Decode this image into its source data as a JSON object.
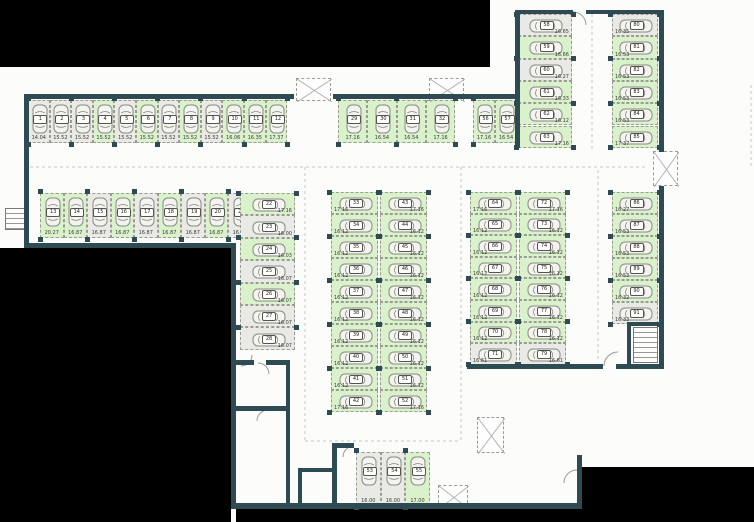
{
  "title": "underground-parking-floor-plan",
  "colors": {
    "wall": "#2e4a52",
    "space_available": "#d9f2cc",
    "space_unavailable": "#e9e9e5",
    "outside": "#000000",
    "background": "#fcfcfa",
    "cell_border": "#9b9b93",
    "text": "#3a3a36"
  },
  "floor_plan": {
    "groups": [
      {
        "id": "top-row",
        "type": "vrow",
        "x": 28,
        "y": 100,
        "cw": 21.6,
        "ch": 43,
        "spaces": [
          {
            "number": "1",
            "size": "14.04",
            "state": "unavailable"
          },
          {
            "number": "2",
            "size": "15.52",
            "state": "unavailable"
          },
          {
            "number": "3",
            "size": "15.52",
            "state": "unavailable"
          },
          {
            "number": "4",
            "size": "15.52",
            "state": "available"
          },
          {
            "number": "5",
            "size": "15.52",
            "state": "unavailable"
          },
          {
            "number": "6",
            "size": "15.52",
            "state": "available"
          },
          {
            "number": "7",
            "size": "15.52",
            "state": "unavailable"
          },
          {
            "number": "8",
            "size": "15.52",
            "state": "available"
          },
          {
            "number": "9",
            "size": "15.52",
            "state": "unavailable"
          },
          {
            "number": "10",
            "size": "16.06",
            "state": "available"
          },
          {
            "number": "11",
            "size": "16.35",
            "state": "available"
          },
          {
            "number": "12",
            "size": "17.37",
            "state": "available"
          }
        ]
      },
      {
        "id": "top-mid-row",
        "type": "vrow",
        "x": 338,
        "y": 100,
        "cw": 29.3,
        "ch": 43,
        "spaces": [
          {
            "number": "29",
            "size": "17.16",
            "state": "available"
          },
          {
            "number": "30",
            "size": "16.54",
            "state": "available"
          },
          {
            "number": "31",
            "size": "16.54",
            "state": "available"
          },
          {
            "number": "32",
            "size": "17.16",
            "state": "available"
          }
        ]
      },
      {
        "id": "top-right-pair",
        "type": "vrow",
        "x": 473,
        "y": 100,
        "cw": 22,
        "ch": 43,
        "spaces": [
          {
            "number": "56",
            "size": "17.16",
            "state": "available"
          },
          {
            "number": "57",
            "size": "16.54",
            "state": "available"
          }
        ]
      },
      {
        "id": "col-58-63",
        "type": "hcol",
        "x": 518,
        "y": 14,
        "cw": 54,
        "ch": 22.3,
        "side": "right",
        "spaces": [
          {
            "number": "58",
            "size": "16.65",
            "state": "unavailable"
          },
          {
            "number": "59",
            "size": "16.66",
            "state": "available"
          },
          {
            "number": "60",
            "size": "16.27",
            "state": "unavailable"
          },
          {
            "number": "61",
            "size": "16.33",
            "state": "available"
          },
          {
            "number": "62",
            "size": "16.12",
            "state": "available"
          },
          {
            "number": "63",
            "size": "17.16",
            "state": "available"
          }
        ]
      },
      {
        "id": "right-col-top",
        "type": "hcol",
        "x": 612,
        "y": 14,
        "cw": 46,
        "ch": 22.3,
        "side": "left",
        "spaces": [
          {
            "number": "80",
            "size": "16.35",
            "state": "unavailable"
          },
          {
            "number": "81",
            "size": "16.53",
            "state": "available"
          },
          {
            "number": "82",
            "size": "16.53",
            "state": "available"
          },
          {
            "number": "83",
            "size": "16.53",
            "state": "available"
          },
          {
            "number": "84",
            "size": "16.53",
            "state": "available"
          },
          {
            "number": "85",
            "size": "17.37",
            "state": "available"
          }
        ]
      },
      {
        "id": "right-col-bottom",
        "type": "hcol",
        "x": 612,
        "y": 192,
        "cw": 46,
        "ch": 22,
        "side": "left",
        "spaces": [
          {
            "number": "86",
            "size": "16.27",
            "state": "available"
          },
          {
            "number": "87",
            "size": "16.53",
            "state": "available"
          },
          {
            "number": "88",
            "size": "16.53",
            "state": "available"
          },
          {
            "number": "89",
            "size": "16.53",
            "state": "available"
          },
          {
            "number": "90",
            "size": "16.32",
            "state": "available"
          },
          {
            "number": "91",
            "size": "16.33",
            "state": "unavailable"
          }
        ]
      },
      {
        "id": "second-row",
        "type": "vrow",
        "x": 40,
        "y": 193,
        "cw": 23.5,
        "ch": 45,
        "spaces": [
          {
            "number": "13",
            "size": "20.27",
            "state": "available"
          },
          {
            "number": "14",
            "size": "16.87",
            "state": "available"
          },
          {
            "number": "15",
            "size": "16.87",
            "state": "unavailable"
          },
          {
            "number": "16",
            "size": "16.87",
            "state": "available"
          },
          {
            "number": "17",
            "size": "16.87",
            "state": "unavailable"
          },
          {
            "number": "18",
            "size": "16.87",
            "state": "available"
          },
          {
            "number": "19",
            "size": "16.87",
            "state": "unavailable"
          },
          {
            "number": "20",
            "size": "16.87",
            "state": "available"
          },
          {
            "number": "21",
            "size": "16.87",
            "state": "unavailable"
          }
        ]
      },
      {
        "id": "left-stack",
        "type": "hcol",
        "x": 240,
        "y": 193,
        "cw": 55,
        "ch": 22.4,
        "side": "right",
        "spaces": [
          {
            "number": "22",
            "size": "17.16",
            "state": "available"
          },
          {
            "number": "23",
            "size": "16.00",
            "state": "unavailable"
          },
          {
            "number": "24",
            "size": "16.03",
            "state": "available"
          },
          {
            "number": "25",
            "size": "16.07",
            "state": "unavailable"
          },
          {
            "number": "26",
            "size": "16.07",
            "state": "available"
          },
          {
            "number": "27",
            "size": "16.07",
            "state": "unavailable"
          },
          {
            "number": "28",
            "size": "16.07",
            "state": "unavailable"
          }
        ]
      },
      {
        "id": "center-left-col",
        "type": "hcol",
        "x": 331,
        "y": 192,
        "cw": 47,
        "ch": 22,
        "side": "left",
        "spaces": [
          {
            "number": "33",
            "size": "17.16",
            "state": "available"
          },
          {
            "number": "34",
            "size": "16.12",
            "state": "available"
          },
          {
            "number": "35",
            "size": "16.12",
            "state": "available"
          },
          {
            "number": "36",
            "size": "16.12",
            "state": "available"
          },
          {
            "number": "37",
            "size": "16.12",
            "state": "available"
          },
          {
            "number": "38",
            "size": "16.12",
            "state": "available"
          },
          {
            "number": "39",
            "size": "16.12",
            "state": "available"
          },
          {
            "number": "40",
            "size": "16.12",
            "state": "available"
          },
          {
            "number": "41",
            "size": "16.12",
            "state": "available"
          },
          {
            "number": "42",
            "size": "17.16",
            "state": "available"
          }
        ]
      },
      {
        "id": "center-right-col",
        "type": "hcol",
        "x": 380,
        "y": 192,
        "cw": 47,
        "ch": 22,
        "side": "right",
        "spaces": [
          {
            "number": "43",
            "size": "17.16",
            "state": "available"
          },
          {
            "number": "44",
            "size": "16.12",
            "state": "available"
          },
          {
            "number": "45",
            "size": "16.12",
            "state": "available"
          },
          {
            "number": "46",
            "size": "16.12",
            "state": "available"
          },
          {
            "number": "47",
            "size": "16.12",
            "state": "available"
          },
          {
            "number": "48",
            "size": "16.12",
            "state": "available"
          },
          {
            "number": "49",
            "size": "16.12",
            "state": "available"
          },
          {
            "number": "50",
            "size": "16.12",
            "state": "available"
          },
          {
            "number": "51",
            "size": "16.12",
            "state": "available"
          },
          {
            "number": "52",
            "size": "17.16",
            "state": "available"
          }
        ]
      },
      {
        "id": "right-block-left",
        "type": "hcol",
        "x": 470,
        "y": 192,
        "cw": 47,
        "ch": 21.6,
        "side": "left",
        "spaces": [
          {
            "number": "64",
            "size": "17.16",
            "state": "available"
          },
          {
            "number": "65",
            "size": "16.12",
            "state": "available"
          },
          {
            "number": "66",
            "size": "16.12",
            "state": "available"
          },
          {
            "number": "67",
            "size": "16.12",
            "state": "available"
          },
          {
            "number": "68",
            "size": "16.12",
            "state": "available"
          },
          {
            "number": "69",
            "size": "16.12",
            "state": "available"
          },
          {
            "number": "70",
            "size": "16.12",
            "state": "available"
          },
          {
            "number": "71",
            "size": "16.61",
            "state": "unavailable"
          }
        ]
      },
      {
        "id": "right-block-right",
        "type": "hcol",
        "x": 519,
        "y": 192,
        "cw": 47,
        "ch": 21.6,
        "side": "right",
        "spaces": [
          {
            "number": "72",
            "size": "17.16",
            "state": "available"
          },
          {
            "number": "73",
            "size": "16.12",
            "state": "available"
          },
          {
            "number": "74",
            "size": "16.12",
            "state": "available"
          },
          {
            "number": "75",
            "size": "16.12",
            "state": "available"
          },
          {
            "number": "76",
            "size": "16.12",
            "state": "available"
          },
          {
            "number": "77",
            "size": "16.12",
            "state": "available"
          },
          {
            "number": "78",
            "size": "16.12",
            "state": "available"
          },
          {
            "number": "79",
            "size": "16.61",
            "state": "unavailable"
          }
        ]
      },
      {
        "id": "bottom-center",
        "type": "vrow",
        "x": 356,
        "y": 452,
        "cw": 24.6,
        "ch": 54,
        "spaces": [
          {
            "number": "53",
            "size": "16.00",
            "state": "unavailable"
          },
          {
            "number": "54",
            "size": "16.00",
            "state": "unavailable"
          },
          {
            "number": "55",
            "size": "17.00",
            "state": "available"
          }
        ]
      }
    ],
    "outside_areas": [
      [
        0,
        0,
        490,
        67
      ],
      [
        0,
        248,
        231,
        274
      ],
      [
        236,
        509,
        346,
        13
      ],
      [
        582,
        467,
        172,
        55
      ]
    ],
    "walls": [
      [
        24,
        94,
        270,
        5
      ],
      [
        333,
        94,
        132,
        5
      ],
      [
        465,
        94,
        55,
        5
      ],
      [
        24,
        94,
        5,
        154
      ],
      [
        24,
        243,
        212,
        5
      ],
      [
        231,
        243,
        5,
        266
      ],
      [
        515,
        10,
        5,
        138
      ],
      [
        518,
        10,
        55,
        4
      ],
      [
        586,
        10,
        78,
        4
      ],
      [
        659,
        10,
        5,
        142
      ],
      [
        659,
        186,
        5,
        138
      ],
      [
        467,
        364,
        136,
        5
      ],
      [
        616,
        364,
        48,
        5
      ],
      [
        627,
        322,
        4,
        47
      ],
      [
        627,
        322,
        37,
        4
      ],
      [
        659,
        322,
        5,
        47
      ],
      [
        332,
        443,
        22,
        5
      ],
      [
        332,
        443,
        5,
        66
      ],
      [
        236,
        503,
        346,
        6
      ],
      [
        577,
        455,
        5,
        54
      ],
      [
        236,
        360,
        18,
        5
      ],
      [
        266,
        360,
        24,
        5
      ],
      [
        286,
        360,
        4,
        147
      ],
      [
        236,
        406,
        54,
        5
      ],
      [
        298,
        468,
        34,
        4
      ],
      [
        298,
        468,
        4,
        36
      ]
    ],
    "shafts": [
      [
        296,
        78,
        35,
        23
      ],
      [
        429,
        78,
        35,
        23
      ],
      [
        653,
        151,
        25,
        35
      ],
      [
        477,
        417,
        27,
        36
      ],
      [
        438,
        485,
        30,
        23
      ]
    ],
    "stairs": [
      [
        633,
        327,
        25,
        36
      ],
      [
        5,
        208,
        24,
        22
      ]
    ],
    "doors": [
      "M573,12 A13 13 0 0 1 586,25",
      "M354,446 A11 11 0 0 0 343,457",
      "M604,366 A14 14 0 0 1 618,352",
      "M258,363 A11 11 0 0 1 269,374",
      "M268,410 A11 11 0 0 0 257,421",
      "M577,470 A13 13 0 0 0 564,483",
      "M252,355 A11 11 0 0 1 241,366"
    ],
    "lane_lines": [
      [
        30,
        167,
        648,
        167
      ],
      [
        305,
        167,
        305,
        441
      ],
      [
        461,
        167,
        461,
        443
      ],
      [
        305,
        441,
        460,
        441
      ],
      [
        592,
        14,
        592,
        150
      ],
      [
        598,
        170,
        598,
        362
      ],
      [
        751,
        85,
        751,
        167
      ]
    ]
  }
}
